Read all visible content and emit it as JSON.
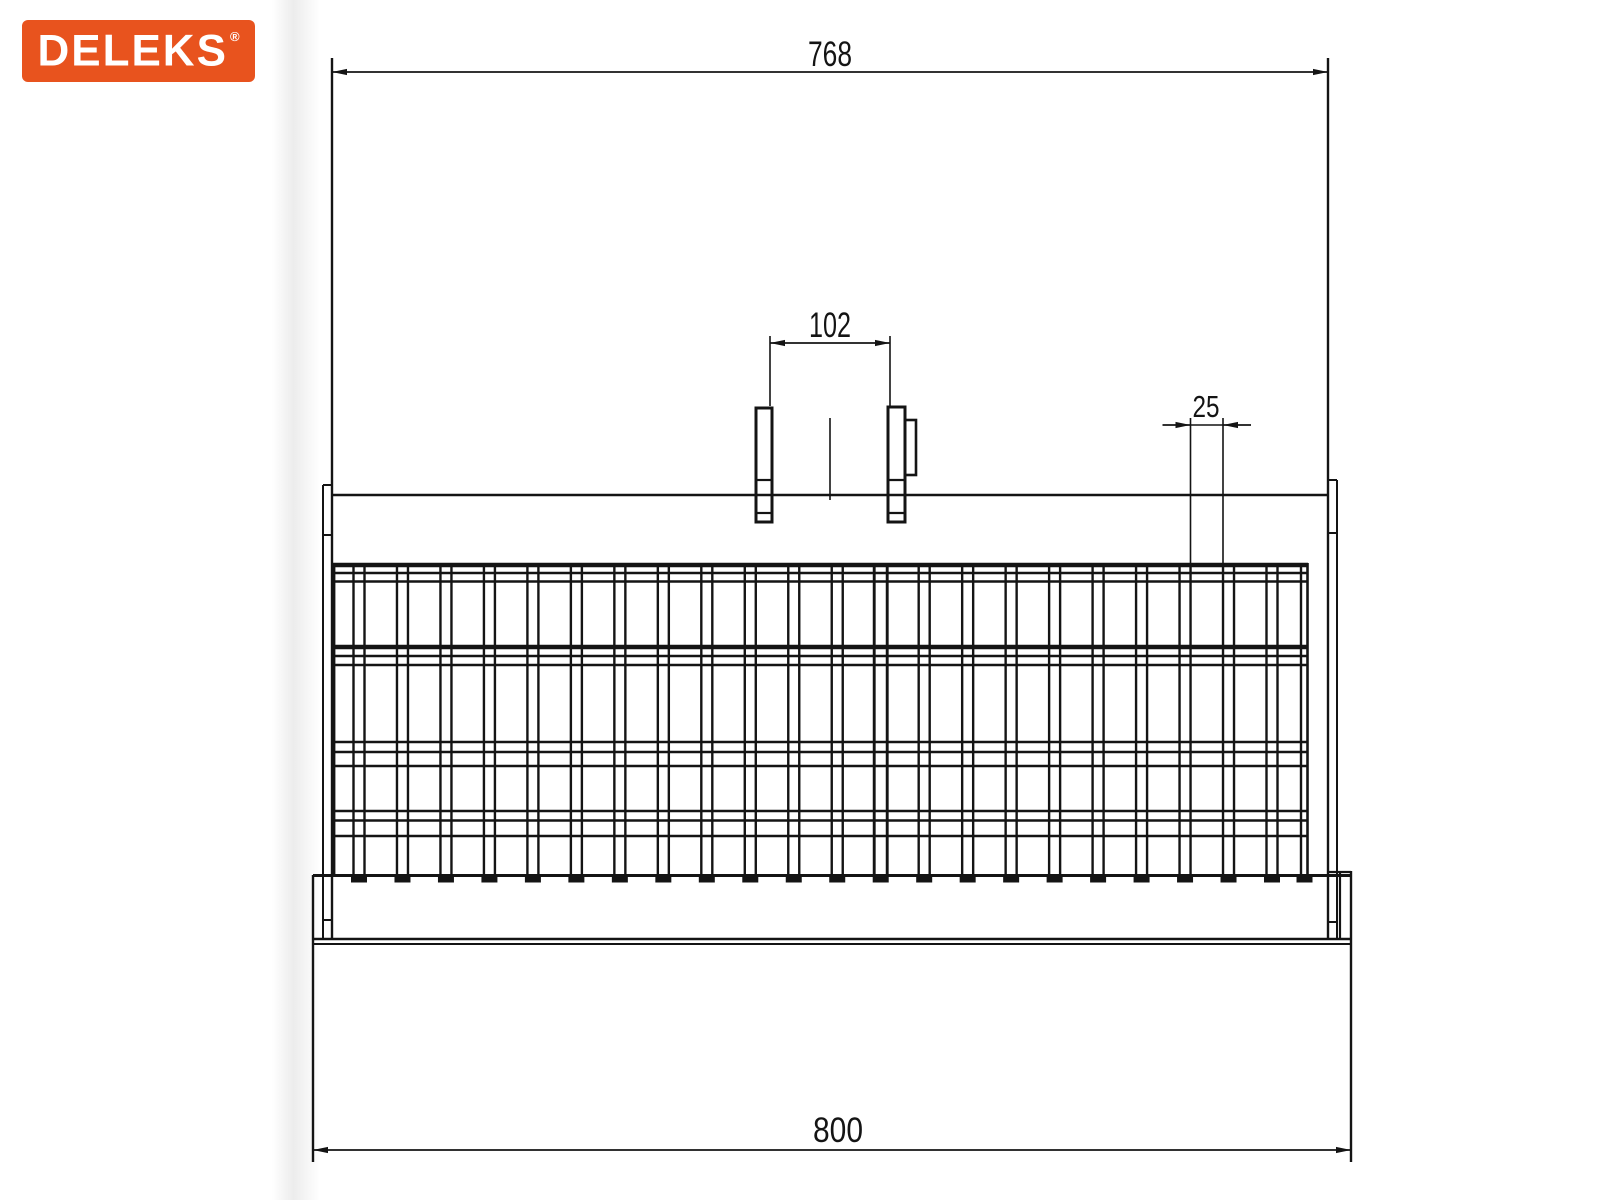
{
  "page": {
    "background": "#ffffff",
    "edge_shade_color": "#c9c9c9"
  },
  "logo": {
    "text": "DELEKS",
    "registered_mark": "®",
    "background_color": "#E8531E",
    "text_color": "#FFFFFF"
  },
  "drawing": {
    "line_color": "#141414",
    "dimensions": {
      "top_width": {
        "label": "768"
      },
      "bracket_spacing": {
        "label": "102"
      },
      "tine_gap": {
        "label": "25"
      },
      "bottom_width": {
        "label": "800"
      }
    },
    "geometry": {
      "canvas": {
        "w": 1600,
        "h": 1200
      },
      "vlines": [
        [
          332,
          58,
          938,
          2.4
        ],
        [
          323,
          485,
          938,
          2
        ],
        [
          1328,
          58,
          938,
          2.4
        ],
        [
          1337,
          480,
          938,
          2
        ],
        [
          313,
          875,
          1162,
          2.4
        ],
        [
          1351,
          871,
          1162,
          2.4
        ],
        [
          1340,
          871,
          939,
          2.2
        ],
        [
          334,
          563,
          875,
          2.8
        ],
        [
          1301,
          563,
          875,
          2.4
        ],
        [
          1307.5,
          563,
          875,
          2.6
        ],
        [
          830,
          418,
          500,
          1.6
        ]
      ],
      "hlines": [
        [
          495,
          332,
          1328,
          2.4
        ],
        [
          565,
          333,
          1308,
          4.5
        ],
        [
          647,
          333,
          1308,
          4.5
        ],
        [
          573,
          334,
          1307,
          2.4
        ],
        [
          581.5,
          334,
          1307,
          2.4
        ],
        [
          656,
          334,
          1307,
          2.4
        ],
        [
          665,
          334,
          1307,
          2.4
        ],
        [
          742,
          334,
          1307,
          2.4
        ],
        [
          752,
          334,
          1307,
          2.4
        ],
        [
          766,
          334,
          1307,
          2.6
        ],
        [
          811,
          334,
          1307,
          2.4
        ],
        [
          820.5,
          334,
          1307,
          2.4
        ],
        [
          836,
          334,
          1307,
          2.6
        ],
        [
          875.5,
          313,
          1351,
          3
        ],
        [
          939,
          313,
          1351,
          2.4
        ],
        [
          944,
          313,
          1351,
          2
        ],
        [
          872,
          1328,
          1351,
          2.2
        ],
        [
          485,
          323,
          332,
          2
        ],
        [
          535,
          323,
          332,
          2
        ],
        [
          920,
          323,
          332,
          2
        ],
        [
          480,
          1328,
          1337,
          2
        ],
        [
          533,
          1328,
          1337,
          2
        ],
        [
          922,
          1328,
          1337,
          2
        ],
        [
          480,
          756,
          772,
          2.2
        ],
        [
          513,
          756,
          772,
          2.2
        ],
        [
          480,
          888,
          905,
          2.2
        ],
        [
          513,
          888,
          905,
          2.2
        ]
      ],
      "rects": [
        [
          756,
          408,
          16,
          114,
          3
        ],
        [
          888,
          407,
          17,
          115,
          3
        ],
        [
          905,
          420,
          11,
          55,
          2.6
        ]
      ],
      "grid": {
        "top": 563,
        "bottom": 875.5,
        "bar_first_center": 359,
        "bar_pitch": 43.476,
        "bar_count": 22,
        "bar_half": 5.5,
        "bar_line_width": 2.4,
        "divider_index": 12,
        "divider_half": 6.5,
        "divider_line_width": 2.9,
        "foot_width": 16,
        "foot_height": 7.5,
        "foot_y": 875,
        "extra_foot_centers": [
          1304.5
        ]
      },
      "dims": {
        "top_width": {
          "y": 72,
          "x1": 332,
          "x2": 1328,
          "text": {
            "x": 830,
            "y": 66,
            "size": 35,
            "tl": 44
          }
        },
        "bracket": {
          "y": 343,
          "x1": 770,
          "x2": 890,
          "ext_y1": 336,
          "ext_y2": 406,
          "text": {
            "x": 830,
            "y": 337,
            "size": 35,
            "tl": 42
          }
        },
        "gap": {
          "y": 425,
          "x1": 1190.5,
          "x2": 1223,
          "tail": 28,
          "ext_y1": 418,
          "ext_y2": 563,
          "text": {
            "x": 1206,
            "y": 417,
            "size": 31,
            "tl": 27
          }
        },
        "bottom_width": {
          "y": 1150,
          "x1": 313,
          "x2": 1351,
          "text": {
            "x": 838,
            "y": 1142,
            "size": 35,
            "tl": 50
          }
        }
      }
    }
  }
}
